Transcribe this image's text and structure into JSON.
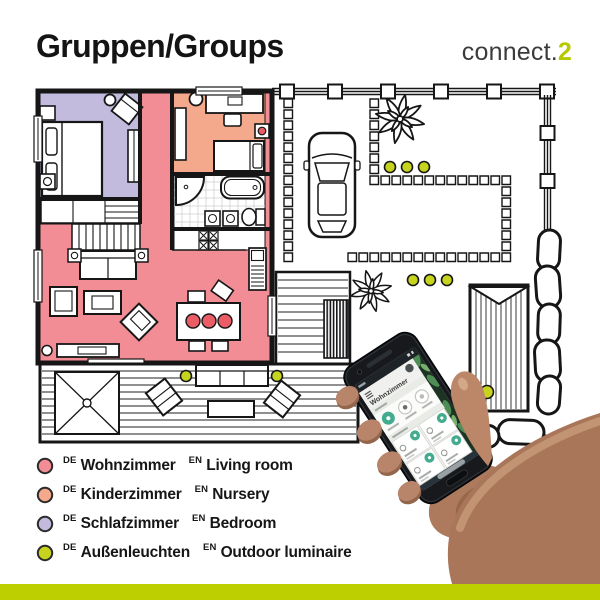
{
  "header": {
    "title": "Gruppen/Groups",
    "logo_text": "connect.",
    "logo_accent": "2"
  },
  "colors": {
    "living_room": "#f28d96",
    "nursery": "#f5a98c",
    "bedroom": "#c2bbdd",
    "outdoor": "#c6d41d",
    "accent_lime": "#bdcf00",
    "logo_accent_color": "#b4c900",
    "app_green": "#43ab8e",
    "furniture_accent": "#ea5c66"
  },
  "phone": {
    "app_title": "Wohnzimmer"
  },
  "legend": {
    "items": [
      {
        "de_tag": "DE",
        "de": "Wohnzimmer",
        "en_tag": "EN",
        "en": "Living room",
        "color": "#f28d96"
      },
      {
        "de_tag": "DE",
        "de": "Kinderzimmer",
        "en_tag": "EN",
        "en": "Nursery",
        "color": "#f5a98c"
      },
      {
        "de_tag": "DE",
        "de": "Schlafzimmer",
        "en_tag": "EN",
        "en": "Bedroom",
        "color": "#c2bbdd"
      },
      {
        "de_tag": "DE",
        "de": "Außenleuchten",
        "en_tag": "EN",
        "en": "Outdoor luminaire",
        "color": "#c6d41d"
      }
    ]
  }
}
